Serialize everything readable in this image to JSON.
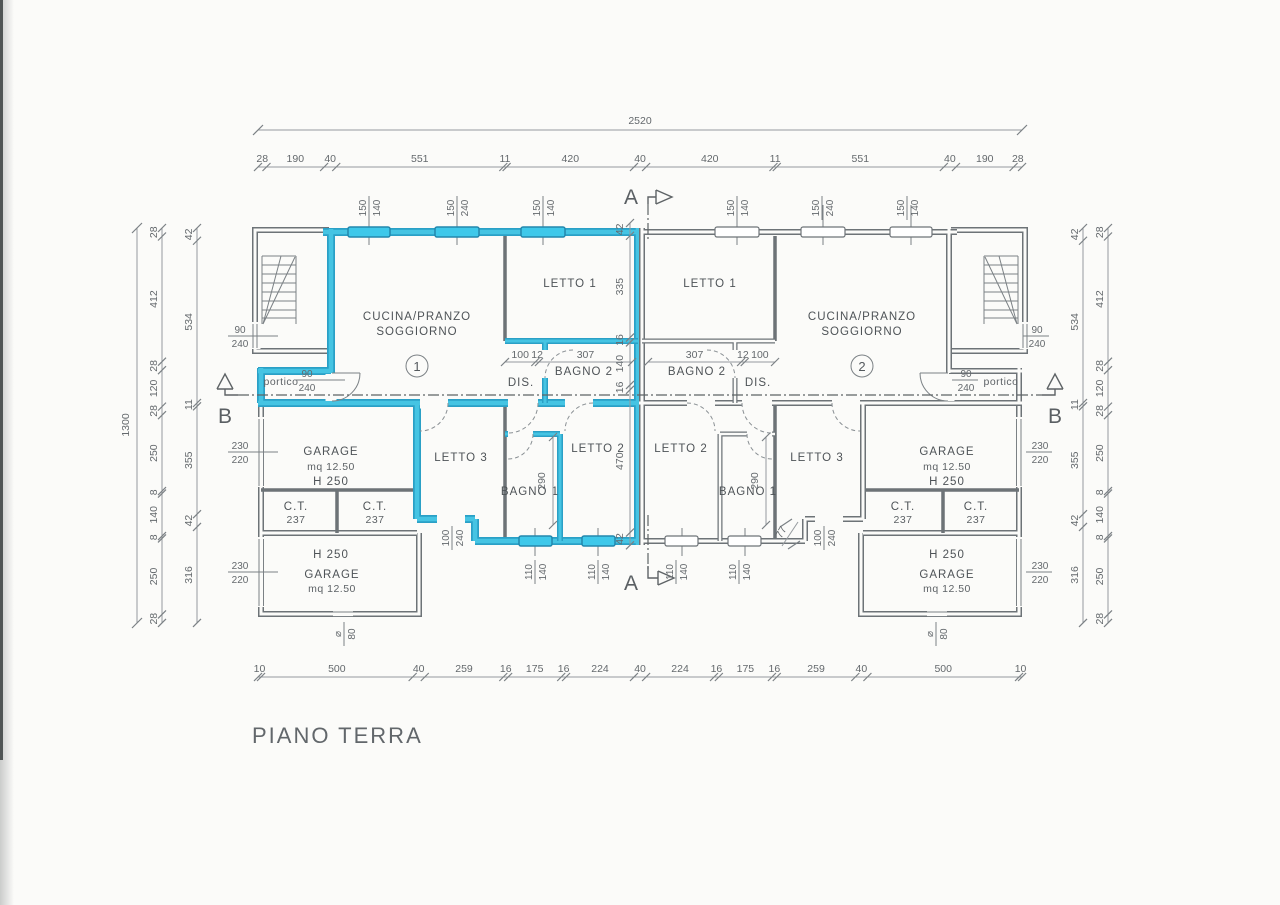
{
  "title": "PIANO  TERRA",
  "section_labels": {
    "a": "A",
    "b": "B"
  },
  "colors": {
    "highlight": "#3ec8ea",
    "wall_gray": "#6d7377",
    "dim_gray": "#959a9e",
    "paper": "#fbfbf9"
  },
  "unit1": {
    "number": "1",
    "cucina_line1": "CUCINA/PRANZO",
    "cucina_line2": "SOGGIORNO",
    "letto1": "LETTO 1",
    "letto2": "LETTO 2",
    "letto3": "LETTO 3",
    "bagno1": "BAGNO 1",
    "bagno2": "BAGNO 2",
    "dis": "DIS.",
    "portico": "portico",
    "garage_top": {
      "name": "GARAGE",
      "area": "mq 12.50",
      "h": "H 250"
    },
    "garage_bottom": {
      "h": "H 250",
      "name": "GARAGE",
      "area": "mq 12.50"
    },
    "ct1": {
      "name": "C.T.",
      "h": "237"
    },
    "ct2": {
      "name": "C.T.",
      "h": "237"
    }
  },
  "unit2": {
    "number": "2",
    "cucina_line1": "CUCINA/PRANZO",
    "cucina_line2": "SOGGIORNO",
    "letto1": "LETTO 1",
    "letto2": "LETTO 2",
    "letto3": "LETTO 3",
    "bagno1": "BAGNO 1",
    "bagno2": "BAGNO 2",
    "dis": "DIS.",
    "portico": "portico",
    "garage_top": {
      "name": "GARAGE",
      "area": "mq 12.50",
      "h": "H 250"
    },
    "garage_bottom": {
      "h": "H 250",
      "name": "GARAGE",
      "area": "mq 12.50"
    },
    "ct1": {
      "name": "C.T.",
      "h": "237"
    },
    "ct2": {
      "name": "C.T.",
      "h": "237"
    }
  },
  "dims": {
    "top_total": "2520",
    "top_chain": [
      "28",
      "190",
      "40",
      "551",
      "11",
      "420",
      "40",
      "420",
      "11",
      "551",
      "40",
      "190",
      "28"
    ],
    "bottom_chain": [
      "10",
      "500",
      "40",
      "259",
      "16",
      "175",
      "16",
      "224",
      "40",
      "224",
      "16",
      "175",
      "16",
      "259",
      "40",
      "500",
      "10"
    ],
    "left_total": "1300",
    "side_outer_chain": [
      "28",
      "412",
      "28",
      "120",
      "28",
      "250",
      "8",
      "140",
      "8",
      "250",
      "28"
    ],
    "side_inner_chain": [
      "42",
      "534",
      "11",
      "355",
      "42",
      "316"
    ],
    "center_chain": [
      "42",
      "335",
      "16",
      "140",
      "16",
      "470",
      "42"
    ],
    "interior": {
      "bagno2_left": [
        "100",
        "12",
        "307"
      ],
      "bagno2_right": [
        "307",
        "12",
        "100"
      ],
      "bagno1_height": "290",
      "step": "77"
    }
  },
  "openings": {
    "win_150_140": "150/140",
    "win_150_240": "150/240",
    "door_90_240": "90/240",
    "win_110_140": "110/140",
    "door_100_240": "100/240",
    "garage_door_230_220": "230/220",
    "small_80": "⌀/80"
  }
}
